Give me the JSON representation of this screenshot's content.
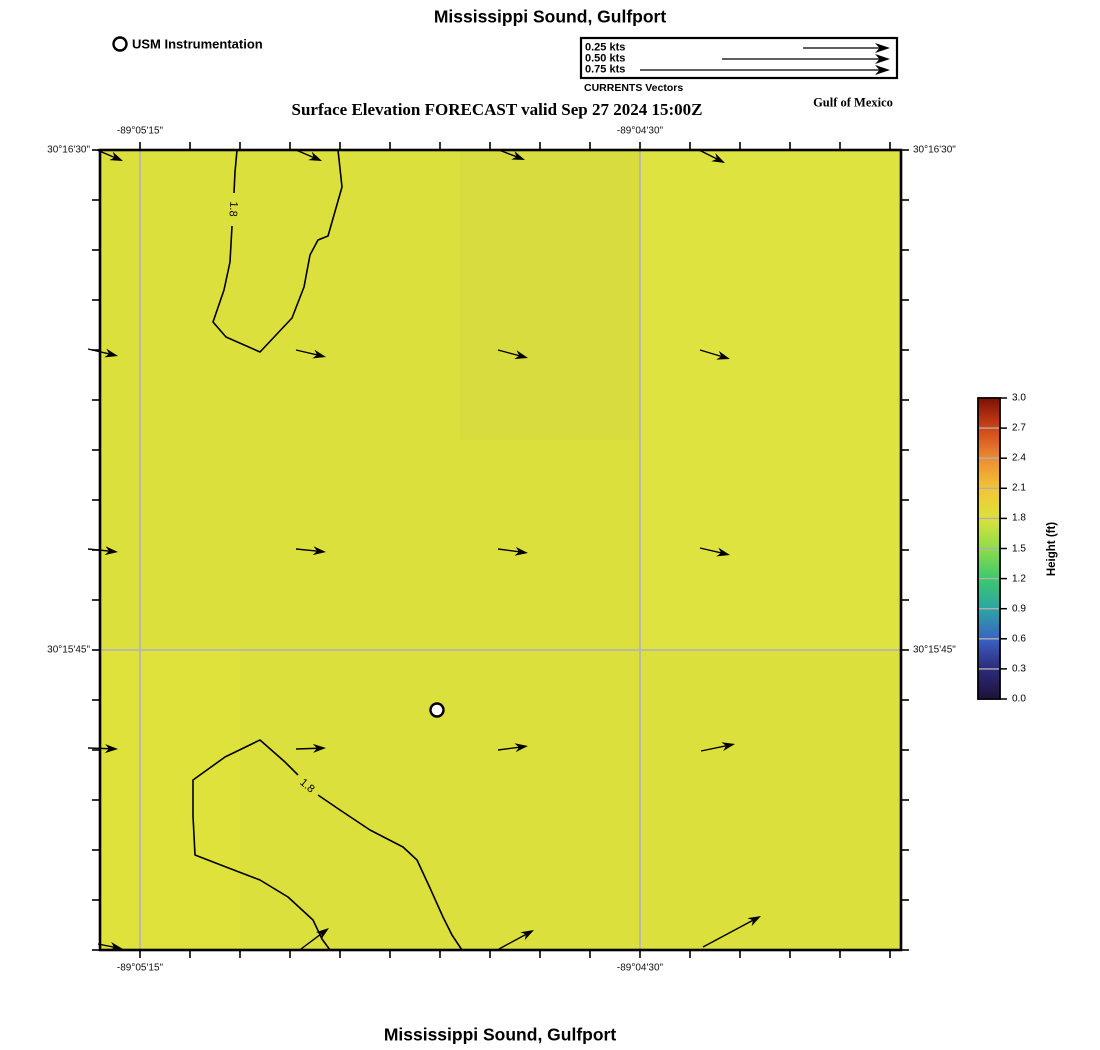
{
  "titles": {
    "top": "Mississippi Sound, Gulfport",
    "subtitle": "Surface Elevation FORECAST valid Sep 27 2024 15:00Z",
    "bottom": "Mississippi Sound, Gulfport",
    "region": "Gulf of Mexico"
  },
  "station_legend": {
    "label": "USM Instrumentation",
    "marker": "open-circle",
    "cx": 120,
    "cy": 44,
    "r": 6.5
  },
  "currents_legend": {
    "caption": "CURRENTS Vectors",
    "box": {
      "x": 581,
      "y": 38,
      "w": 316,
      "h": 40
    },
    "head_x": 890,
    "entries": [
      {
        "label": "0.25 kts",
        "tail_x": 803,
        "y": 48
      },
      {
        "label": "0.50 kts",
        "tail_x": 722,
        "y": 59
      },
      {
        "label": "0.75 kts",
        "tail_x": 640,
        "y": 70
      }
    ]
  },
  "map": {
    "frame": {
      "x": 100,
      "y": 150,
      "w": 801,
      "h": 800
    },
    "bg_color": "#dce03c",
    "shade_patches": [
      {
        "x": 460,
        "y": 150,
        "w": 180,
        "h": 290,
        "c": "#d8dc3e"
      },
      {
        "x": 640,
        "y": 150,
        "w": 261,
        "h": 500,
        "c": "#dfe33f"
      },
      {
        "x": 100,
        "y": 650,
        "w": 140,
        "h": 300,
        "c": "#dee23a"
      }
    ],
    "grid_color": "#b5b5b5",
    "v_gridlines": [
      140,
      640
    ],
    "h_gridlines": [
      650
    ],
    "x_ticks": [
      140,
      190,
      240,
      290,
      340,
      390,
      440,
      490,
      540,
      590,
      640,
      690,
      740,
      790,
      840,
      890
    ],
    "y_ticks": [
      150,
      200,
      250,
      300,
      350,
      400,
      450,
      500,
      550,
      600,
      650,
      700,
      750,
      800,
      850,
      900,
      950
    ],
    "x_labels": [
      {
        "text": "-89°05'15\"",
        "x": 140
      },
      {
        "text": "-89°04'30\"",
        "x": 640
      }
    ],
    "y_labels": [
      {
        "text": "30°16'30\"",
        "y": 150
      },
      {
        "text": "30°15'45\"",
        "y": 650
      }
    ],
    "contours": [
      {
        "points": [
          [
            237,
            150
          ],
          [
            235,
            172
          ],
          [
            234,
            193
          ]
        ]
      },
      {
        "points": [
          [
            232,
            226
          ],
          [
            230,
            262
          ],
          [
            224,
            290
          ],
          [
            213,
            322
          ],
          [
            226,
            337
          ],
          [
            260,
            352
          ],
          [
            292,
            318
          ],
          [
            304,
            287
          ],
          [
            310,
            255
          ],
          [
            318,
            240
          ],
          [
            328,
            236
          ],
          [
            342,
            187
          ],
          [
            338,
            150
          ]
        ]
      },
      {
        "points": [
          [
            330,
            950
          ],
          [
            322,
            939
          ],
          [
            313,
            920
          ],
          [
            288,
            897
          ],
          [
            260,
            880
          ],
          [
            226,
            867
          ],
          [
            195,
            855
          ],
          [
            193,
            816
          ],
          [
            193,
            780
          ],
          [
            225,
            757
          ],
          [
            260,
            740
          ],
          [
            285,
            762
          ],
          [
            298,
            775
          ]
        ]
      },
      {
        "points": [
          [
            318,
            795
          ],
          [
            340,
            810
          ],
          [
            370,
            830
          ],
          [
            403,
            847
          ],
          [
            417,
            860
          ],
          [
            430,
            888
          ],
          [
            443,
            917
          ],
          [
            452,
            935
          ],
          [
            462,
            950
          ]
        ]
      }
    ],
    "contour_labels": [
      {
        "text": "1.8",
        "x": 233,
        "y": 209,
        "rot": 93
      },
      {
        "text": "1.8",
        "x": 307,
        "y": 786,
        "rot": 40
      }
    ],
    "arrows": [
      [
        97,
        150,
        123,
        161
      ],
      [
        296,
        150,
        322,
        161
      ],
      [
        499,
        150,
        525,
        160
      ],
      [
        699,
        150,
        725,
        163
      ],
      [
        88,
        349,
        118,
        356
      ],
      [
        296,
        350,
        326,
        357
      ],
      [
        498,
        350,
        528,
        358
      ],
      [
        700,
        350,
        730,
        359
      ],
      [
        88,
        549,
        118,
        552
      ],
      [
        296,
        549,
        326,
        552
      ],
      [
        498,
        549,
        528,
        553
      ],
      [
        700,
        548,
        730,
        555
      ],
      [
        88,
        748,
        118,
        749
      ],
      [
        296,
        749,
        326,
        748
      ],
      [
        498,
        750,
        528,
        746
      ],
      [
        701,
        751,
        735,
        744
      ],
      [
        98,
        944,
        123,
        949
      ],
      [
        301,
        949,
        329,
        928
      ],
      [
        499,
        949,
        534,
        930
      ],
      [
        703,
        947,
        761,
        916
      ]
    ],
    "station": {
      "x": 437,
      "y": 710,
      "r": 6.5
    }
  },
  "colorbar": {
    "x": 978,
    "y": 398,
    "w": 22,
    "h": 301,
    "label": "Height (ft)",
    "range": [
      0.0,
      3.0
    ],
    "ticks": [
      "3.0",
      "2.7",
      "2.4",
      "2.1",
      "1.8",
      "1.5",
      "1.2",
      "0.9",
      "0.6",
      "0.3",
      "0.0"
    ],
    "stops": [
      {
        "v": 0.0,
        "c": "#1f1238"
      },
      {
        "v": 0.3,
        "c": "#2d2a7d"
      },
      {
        "v": 0.6,
        "c": "#3a62c4"
      },
      {
        "v": 0.9,
        "c": "#2ba6a4"
      },
      {
        "v": 1.2,
        "c": "#3cc96d"
      },
      {
        "v": 1.5,
        "c": "#8edd49"
      },
      {
        "v": 1.8,
        "c": "#dce13c"
      },
      {
        "v": 2.1,
        "c": "#f3c438"
      },
      {
        "v": 2.4,
        "c": "#ec8b33"
      },
      {
        "v": 2.7,
        "c": "#cf4517"
      },
      {
        "v": 3.0,
        "c": "#7e0f03"
      }
    ]
  },
  "chart_data": {
    "type": "heatmap",
    "title": "Mississippi Sound, Gulfport",
    "subtitle": "Surface Elevation FORECAST valid Sep 27 2024 15:00Z",
    "x_axis": {
      "label": "Longitude",
      "tick_labels": [
        "-89°05'15\"",
        "-89°04'30\""
      ]
    },
    "y_axis": {
      "label": "Latitude",
      "tick_labels": [
        "30°16'30\"",
        "30°15'45\""
      ]
    },
    "colorbar": {
      "label": "Height (ft)",
      "min": 0.0,
      "max": 3.0,
      "tick_step": 0.3
    },
    "field_description": "Surface elevation nearly uniform ~1.7-1.8 ft (yellow-green) over the whole domain",
    "contour_levels": [
      1.8
    ],
    "contour_regions": 2,
    "vector_legend_kts": [
      0.25,
      0.5,
      0.75
    ],
    "vector_grid": {
      "cols": 4,
      "rows": 5,
      "direction": "mostly eastward, turning northeast near the southern edge",
      "approx_speed_kts": "0.2-0.5"
    },
    "station_marker": {
      "name": "USM Instrumentation",
      "lon_px": 437,
      "lat_px": 710
    },
    "legend_position": "top-right",
    "grid": true
  }
}
